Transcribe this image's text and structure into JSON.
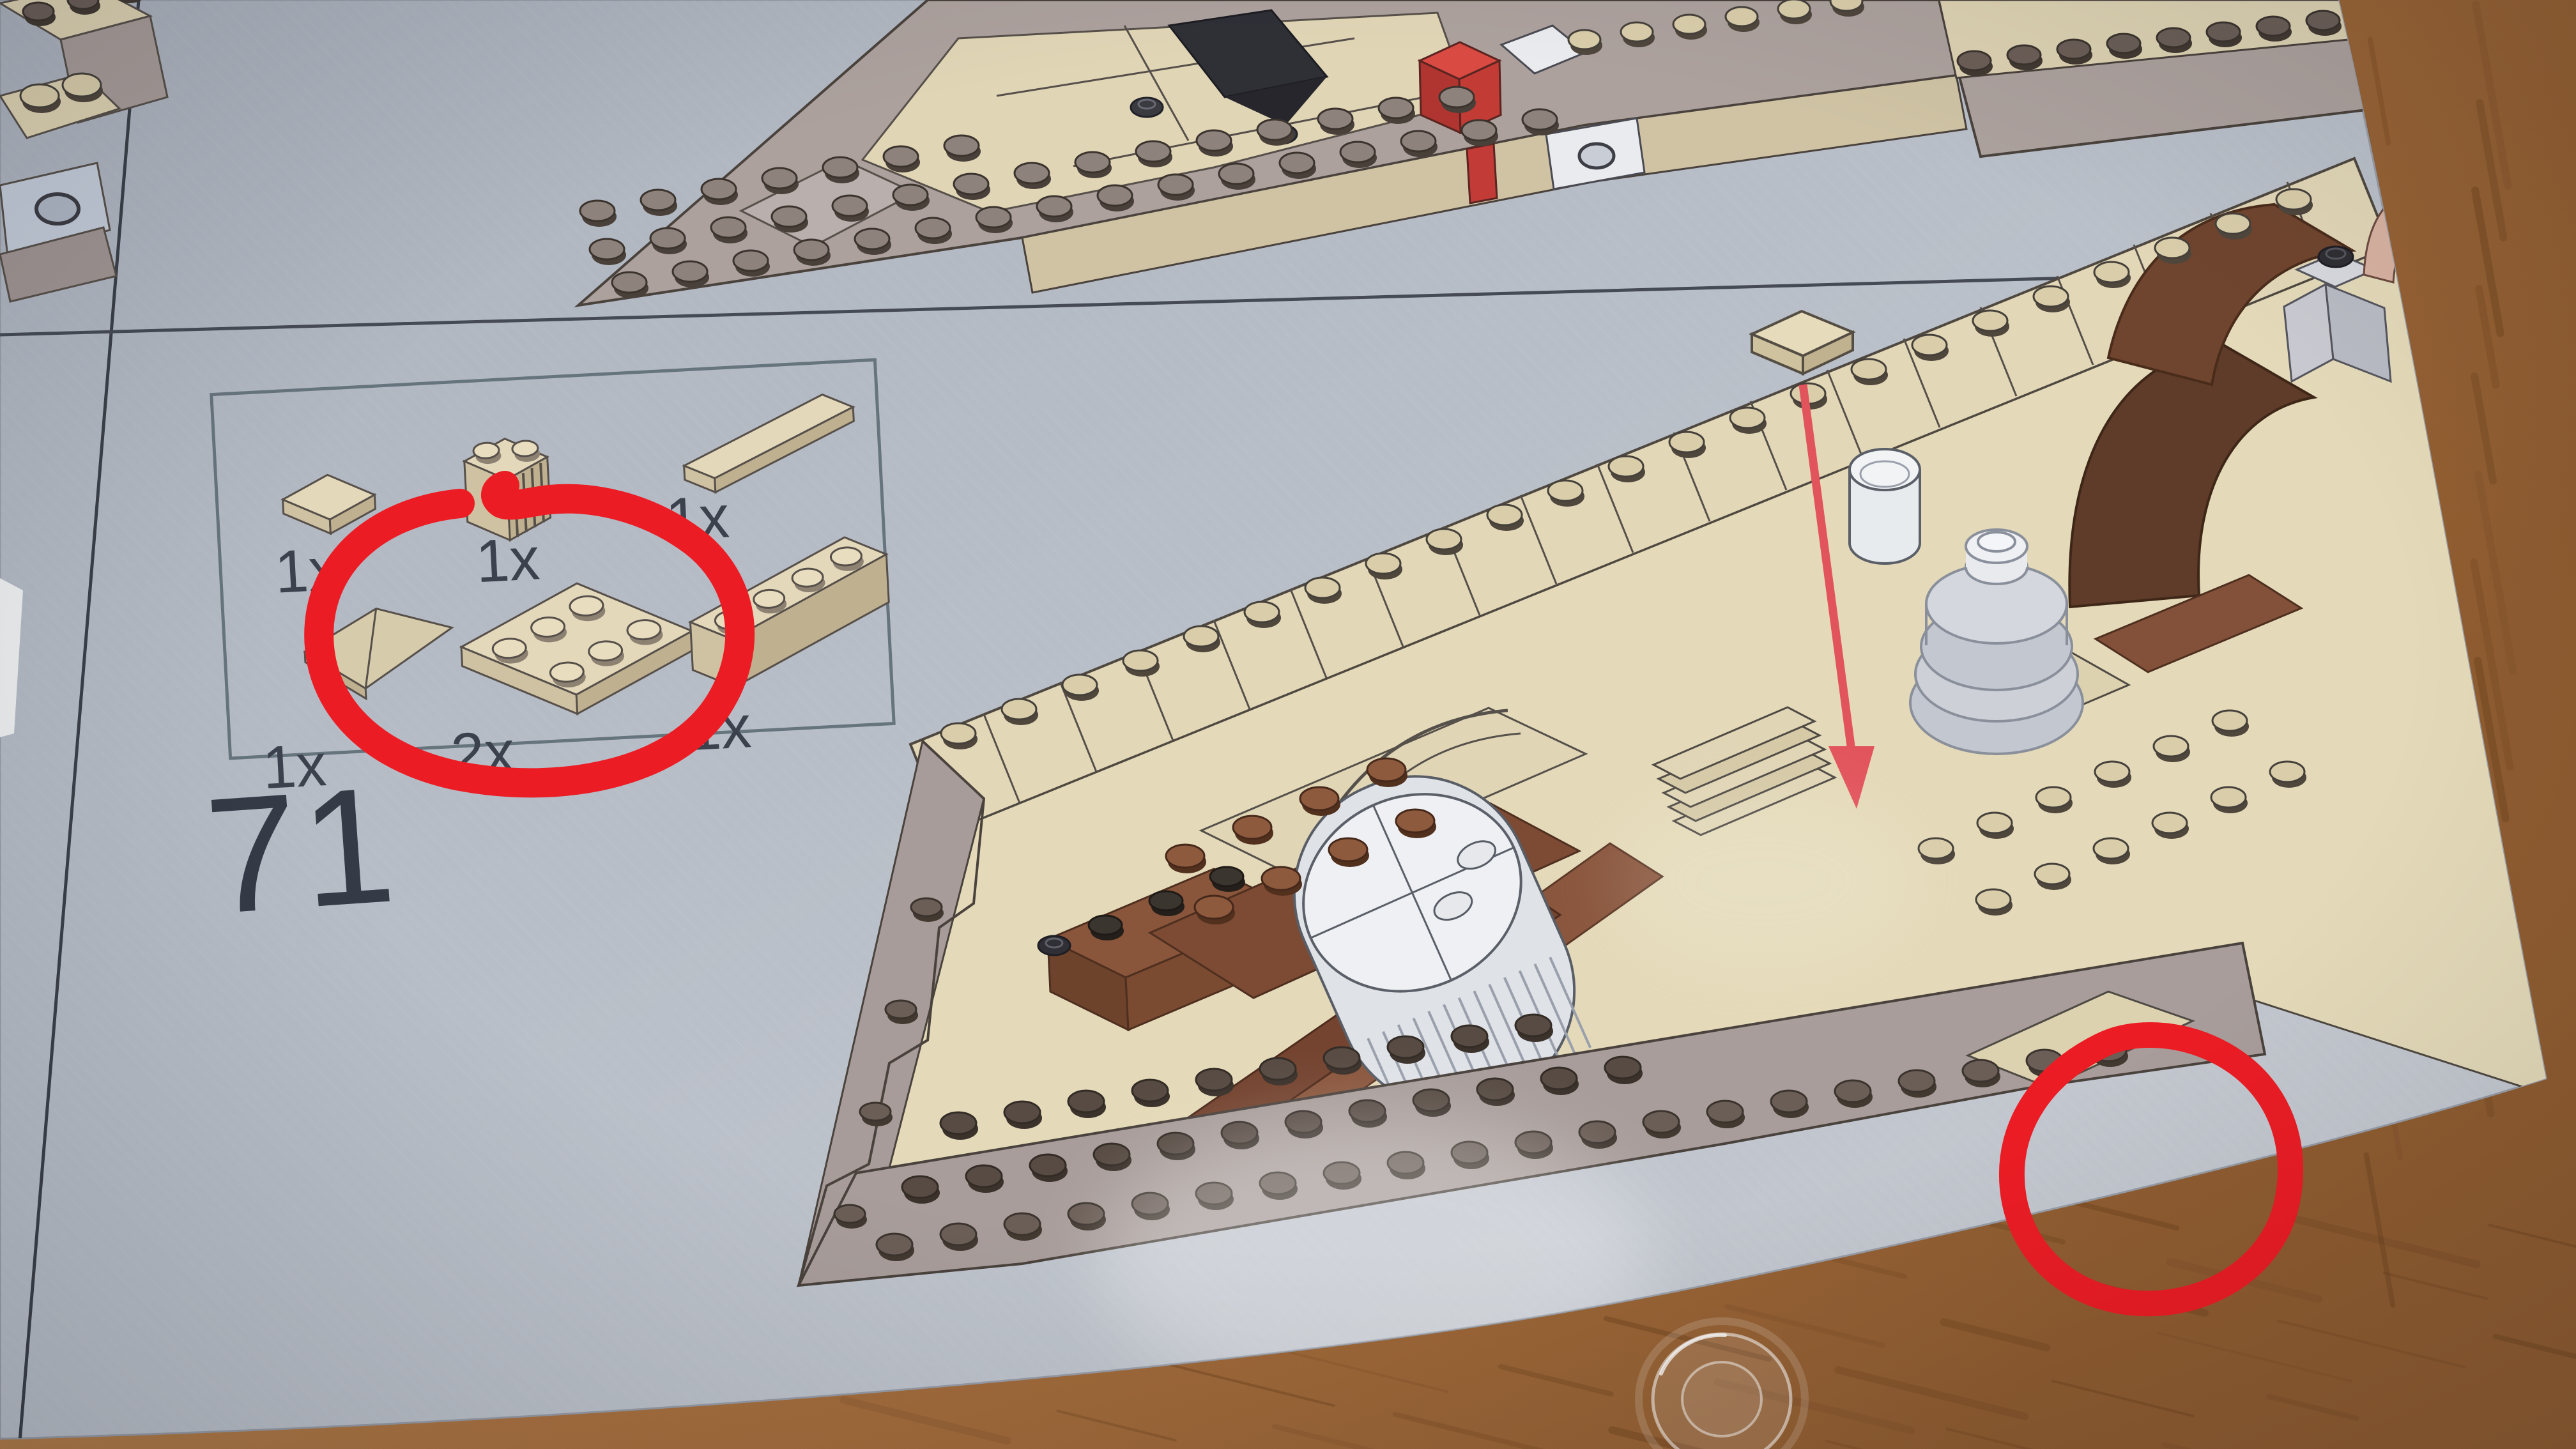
{
  "page": {
    "step_number": "71",
    "page_number": "21",
    "paper_color": "#b9bfc8",
    "line_color": "#3d434d"
  },
  "parts_box": {
    "items": [
      {
        "count": "1x",
        "part": "tan 1x2 flat tile"
      },
      {
        "count": "1x",
        "part": "tan 1x2 grille brick"
      },
      {
        "count": "1x",
        "part": "tan 1x6 tile"
      },
      {
        "count": "1x",
        "part": "tan wedge plate"
      },
      {
        "count": "2x",
        "part": "tan 2x3 plate"
      },
      {
        "count": "1x",
        "part": "tan 1x4 brick"
      }
    ]
  },
  "annotations": {
    "marker_color": "#ec1c24",
    "circled_part_count": "2x",
    "circle_1": "hand-drawn circle around 2x3 plate 2x callout",
    "circle_2": "hand-drawn circle on lower hull edge of diagram",
    "arrow": "red placement arrow pointing to stud on hull"
  },
  "icons": {
    "red_circle_icon": "hand-drawn marker ellipse",
    "red_arrow_icon": "brick placement arrow",
    "transparent_stud_icon": "clear round 1x1 tile on table"
  },
  "colors": {
    "wood_light": "#c2905a",
    "wood_mid": "#a9713f",
    "wood_grain": "#6e441f",
    "tan_brick": "#e0d5b5",
    "tan_shade": "#c9bd9c",
    "mauve_plate": "#a89d9a",
    "stud_dark": "#5a4e47",
    "brown_beam": "#8a563d",
    "dark_brown": "#5f3b29",
    "red_brick": "#c33b36",
    "white_piece": "#eef0f3",
    "gray_machine": "#c9ccd4"
  }
}
